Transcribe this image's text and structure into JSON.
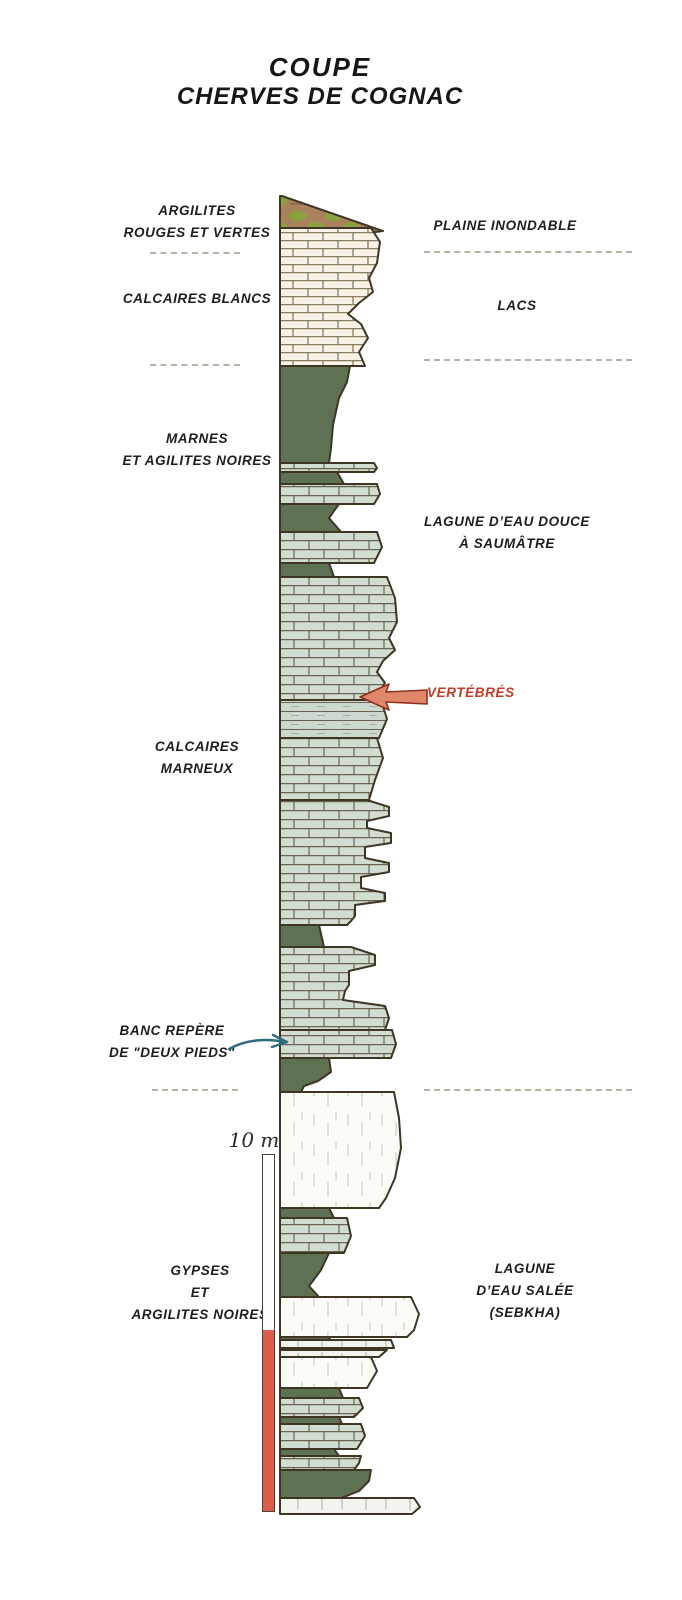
{
  "title": {
    "line1": "COUPE",
    "line2": "CHERVES DE COGNAC"
  },
  "labels": {
    "left": [
      {
        "id": "argilites-rouges-et-vertes",
        "lines": [
          "ARGILITES",
          "ROUGES ET VERTES"
        ]
      },
      {
        "id": "calcaires-blancs",
        "lines": [
          "CALCAIRES BLANCS"
        ]
      },
      {
        "id": "marnes-argilites-noires",
        "lines": [
          "MARNES",
          "ET AGILITES NOIRES"
        ]
      },
      {
        "id": "calcaires-marneux",
        "lines": [
          "CALCAIRES",
          "MARNEUX"
        ]
      },
      {
        "id": "banc-repere",
        "lines": [
          "BANC REPÈRE",
          "DE \"DEUX PIEDS\""
        ]
      },
      {
        "id": "gypses-argilites-noires",
        "lines": [
          "GYPSES",
          "ET",
          "ARGILITES NOIRES"
        ]
      }
    ],
    "right": [
      {
        "id": "plaine-inondable",
        "lines": [
          "PLAINE INONDABLE"
        ]
      },
      {
        "id": "lacs",
        "lines": [
          "LACS"
        ]
      },
      {
        "id": "lagune-eau-douce",
        "lines": [
          "LAGUNE D’EAU DOUCE",
          "À SAUMÂTRE"
        ]
      },
      {
        "id": "lagune-eau-salee",
        "lines": [
          "LAGUNE",
          "D’EAU SALÉE",
          "(SEBKHA)"
        ]
      }
    ],
    "annotations": [
      {
        "id": "vertebres",
        "text": "VERTÉBRÉS",
        "color": "#c23b27"
      }
    ]
  },
  "scale": {
    "label": "10 m"
  },
  "colors": {
    "outline": "#3f3524",
    "marl_green": "#5f7153",
    "limestone_white": "#f8f3e6",
    "limestone_grey": "#d1ddd0",
    "gypsum_white": "#fcfcf7",
    "wedge_brown": "#a8825c",
    "wedge_green": "#8aa23e",
    "accent_red": "#c23b27",
    "arrow_red_fill": "#e0876b",
    "arrow_teal": "#2e6b80",
    "scale_red": "#d95f49",
    "dash_grey": "#b7b1a2"
  },
  "column": {
    "left_x": 280,
    "layers": [
      {
        "name": "argilites-rouges-et-vertes",
        "type": "wedge",
        "top": 196,
        "bottom": 245,
        "profile": [
          [
            196,
            282
          ],
          [
            231,
            383
          ],
          [
            245,
            282
          ]
        ]
      },
      {
        "name": "calcaires-blancs",
        "type": "limestone-white",
        "top": 228,
        "bottom": 366,
        "profile": [
          [
            228,
            371
          ],
          [
            242,
            380
          ],
          [
            263,
            377
          ],
          [
            278,
            369
          ],
          [
            292,
            373
          ],
          [
            303,
            359
          ],
          [
            314,
            348
          ],
          [
            324,
            361
          ],
          [
            338,
            368
          ],
          [
            352,
            359
          ],
          [
            366,
            365
          ]
        ]
      },
      {
        "name": "marnes-et-argilites-noires",
        "type": "marl",
        "top": 366,
        "bottom": 463,
        "profile": [
          [
            366,
            350
          ],
          [
            382,
            347
          ],
          [
            398,
            339
          ],
          [
            425,
            333
          ],
          [
            448,
            331
          ],
          [
            463,
            329
          ]
        ]
      },
      {
        "name": "thin-ledge-1",
        "type": "limestone-grey",
        "top": 463,
        "bottom": 472,
        "profile": [
          [
            463,
            374
          ],
          [
            468,
            377
          ],
          [
            472,
            374
          ]
        ]
      },
      {
        "name": "marl-band-1",
        "type": "marl",
        "top": 472,
        "bottom": 484,
        "profile": [
          [
            472,
            337
          ],
          [
            484,
            344
          ]
        ]
      },
      {
        "name": "ledge-2",
        "type": "limestone-grey",
        "top": 484,
        "bottom": 504,
        "profile": [
          [
            484,
            377
          ],
          [
            494,
            380
          ],
          [
            504,
            374
          ]
        ]
      },
      {
        "name": "marl-band-2",
        "type": "marl",
        "top": 504,
        "bottom": 532,
        "profile": [
          [
            504,
            339
          ],
          [
            518,
            329
          ],
          [
            532,
            341
          ]
        ]
      },
      {
        "name": "ledge-3",
        "type": "limestone-grey",
        "top": 532,
        "bottom": 563,
        "profile": [
          [
            532,
            377
          ],
          [
            547,
            382
          ],
          [
            563,
            374
          ]
        ]
      },
      {
        "name": "marl-band-3",
        "type": "marl",
        "top": 563,
        "bottom": 577,
        "profile": [
          [
            563,
            329
          ],
          [
            577,
            334
          ]
        ]
      },
      {
        "name": "calcaires-marneux-upper",
        "type": "limestone-grey",
        "top": 577,
        "bottom": 700,
        "profile": [
          [
            577,
            387
          ],
          [
            598,
            395
          ],
          [
            622,
            397
          ],
          [
            638,
            389
          ],
          [
            650,
            395
          ],
          [
            661,
            383
          ],
          [
            672,
            377
          ],
          [
            683,
            385
          ],
          [
            692,
            379
          ],
          [
            700,
            371
          ]
        ]
      },
      {
        "name": "laminated-band-vertebres",
        "type": "laminated",
        "top": 700,
        "bottom": 738,
        "profile": [
          [
            700,
            381
          ],
          [
            719,
            387
          ],
          [
            738,
            379
          ]
        ]
      },
      {
        "name": "calcaires-marneux-mid",
        "type": "limestone-grey",
        "top": 738,
        "bottom": 800,
        "profile": [
          [
            738,
            377
          ],
          [
            758,
            383
          ],
          [
            780,
            375
          ],
          [
            800,
            369
          ]
        ]
      },
      {
        "name": "calcaires-marneux-ledges-1",
        "type": "limestone-grey",
        "top": 800,
        "bottom": 925,
        "profile": [
          [
            800,
            367
          ],
          [
            807,
            389
          ],
          [
            816,
            389
          ],
          [
            821,
            367
          ],
          [
            828,
            367
          ],
          [
            833,
            391
          ],
          [
            843,
            391
          ],
          [
            847,
            365
          ],
          [
            858,
            365
          ],
          [
            863,
            389
          ],
          [
            872,
            389
          ],
          [
            877,
            361
          ],
          [
            888,
            361
          ],
          [
            893,
            385
          ],
          [
            901,
            385
          ],
          [
            905,
            355
          ],
          [
            916,
            355
          ],
          [
            921,
            351
          ],
          [
            925,
            347
          ]
        ]
      },
      {
        "name": "marl-band-4",
        "type": "marl",
        "top": 925,
        "bottom": 947,
        "profile": [
          [
            925,
            319
          ],
          [
            947,
            324
          ]
        ]
      },
      {
        "name": "calcaires-marneux-ledges-2",
        "type": "limestone-grey",
        "top": 947,
        "bottom": 1030,
        "profile": [
          [
            947,
            351
          ],
          [
            955,
            375
          ],
          [
            965,
            375
          ],
          [
            971,
            349
          ],
          [
            985,
            349
          ],
          [
            991,
            345
          ],
          [
            1000,
            343
          ],
          [
            1006,
            385
          ],
          [
            1018,
            389
          ],
          [
            1030,
            385
          ]
        ]
      },
      {
        "name": "banc-repere-deux-pieds",
        "type": "limestone-grey",
        "top": 1030,
        "bottom": 1058,
        "profile": [
          [
            1030,
            392
          ],
          [
            1044,
            396
          ],
          [
            1058,
            391
          ]
        ]
      },
      {
        "name": "marl-band-5",
        "type": "marl",
        "top": 1058,
        "bottom": 1092,
        "profile": [
          [
            1058,
            329
          ],
          [
            1072,
            331
          ],
          [
            1081,
            318
          ],
          [
            1086,
            304
          ],
          [
            1092,
            301
          ]
        ]
      },
      {
        "name": "gypse-massif",
        "type": "gypsum",
        "top": 1092,
        "bottom": 1208,
        "profile": [
          [
            1092,
            394
          ],
          [
            1118,
            399
          ],
          [
            1148,
            401
          ],
          [
            1178,
            395
          ],
          [
            1198,
            386
          ],
          [
            1208,
            379
          ]
        ]
      },
      {
        "name": "marl-band-6",
        "type": "marl",
        "top": 1208,
        "bottom": 1218,
        "profile": [
          [
            1208,
            329
          ],
          [
            1218,
            334
          ]
        ]
      },
      {
        "name": "grey-ledge-4",
        "type": "limestone-grey",
        "top": 1218,
        "bottom": 1253,
        "profile": [
          [
            1218,
            347
          ],
          [
            1236,
            351
          ],
          [
            1253,
            344
          ]
        ]
      },
      {
        "name": "marl-band-7",
        "type": "marl",
        "top": 1253,
        "bottom": 1297,
        "profile": [
          [
            1253,
            329
          ],
          [
            1270,
            321
          ],
          [
            1286,
            309
          ],
          [
            1297,
            319
          ]
        ]
      },
      {
        "name": "gypse-2",
        "type": "gypsum",
        "top": 1297,
        "bottom": 1337,
        "profile": [
          [
            1297,
            411
          ],
          [
            1314,
            419
          ],
          [
            1330,
            414
          ],
          [
            1337,
            407
          ]
        ]
      },
      {
        "name": "marl-band-8",
        "type": "marl",
        "top": 1337,
        "bottom": 1349,
        "profile": [
          [
            1337,
            329
          ],
          [
            1349,
            334
          ]
        ]
      },
      {
        "name": "gypse-lens-1",
        "type": "white-band",
        "top": 1340,
        "bottom": 1348,
        "profile": [
          [
            1340,
            391
          ],
          [
            1348,
            394
          ]
        ]
      },
      {
        "name": "gypse-lens-2",
        "type": "white-band",
        "top": 1350,
        "bottom": 1357,
        "profile": [
          [
            1350,
            387
          ],
          [
            1357,
            379
          ]
        ]
      },
      {
        "name": "gypse-3",
        "type": "gypsum",
        "top": 1357,
        "bottom": 1388,
        "profile": [
          [
            1357,
            371
          ],
          [
            1371,
            377
          ],
          [
            1388,
            367
          ]
        ]
      },
      {
        "name": "marl-band-9",
        "type": "marl",
        "top": 1388,
        "bottom": 1398,
        "profile": [
          [
            1388,
            339
          ],
          [
            1398,
            343
          ]
        ]
      },
      {
        "name": "grey-ledge-5",
        "type": "limestone-grey",
        "top": 1398,
        "bottom": 1417,
        "profile": [
          [
            1398,
            359
          ],
          [
            1408,
            363
          ],
          [
            1417,
            354
          ]
        ]
      },
      {
        "name": "marl-band-10",
        "type": "marl",
        "top": 1417,
        "bottom": 1424,
        "profile": [
          [
            1417,
            339
          ],
          [
            1424,
            342
          ]
        ]
      },
      {
        "name": "grey-ledge-6",
        "type": "limestone-grey",
        "top": 1424,
        "bottom": 1449,
        "profile": [
          [
            1424,
            361
          ],
          [
            1436,
            365
          ],
          [
            1449,
            357
          ]
        ]
      },
      {
        "name": "marl-band-11",
        "type": "marl",
        "top": 1449,
        "bottom": 1456,
        "profile": [
          [
            1449,
            334
          ],
          [
            1456,
            339
          ]
        ]
      },
      {
        "name": "grey-ledge-7",
        "type": "limestone-grey",
        "top": 1456,
        "bottom": 1470,
        "profile": [
          [
            1456,
            361
          ],
          [
            1463,
            359
          ],
          [
            1470,
            354
          ]
        ]
      },
      {
        "name": "argilites-base",
        "type": "marl",
        "top": 1470,
        "bottom": 1502,
        "profile": [
          [
            1470,
            371
          ],
          [
            1481,
            369
          ],
          [
            1491,
            359
          ],
          [
            1497,
            344
          ],
          [
            1502,
            329
          ]
        ]
      },
      {
        "name": "white-base-band",
        "type": "white-band",
        "top": 1498,
        "bottom": 1514,
        "profile": [
          [
            1498,
            414
          ],
          [
            1507,
            420
          ],
          [
            1514,
            412
          ]
        ]
      }
    ]
  }
}
